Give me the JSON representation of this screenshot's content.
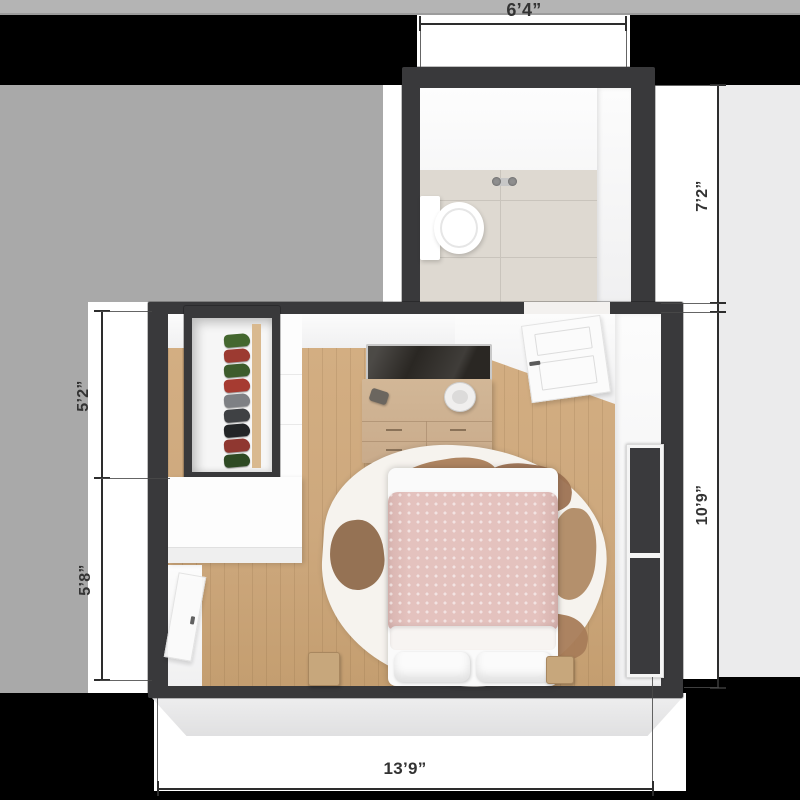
{
  "figure": "3d-floor-plan-top-view",
  "dimensions": {
    "top": "6’4”",
    "right_upper": "7’2”",
    "right_lower": "10’9”",
    "left_upper": "5’2”",
    "left_lower": "5’8”",
    "bottom": "13’9”"
  },
  "palette": {
    "background": "#000000",
    "backdrop_gray": "#a9a9a9",
    "backdrop_light": "#ebebec",
    "top_strip": "#b4b4b4",
    "strip_line": "#9c9c9c",
    "wall": "#39393b",
    "wood_floor": "#cda87d",
    "tile_floor": "#ded9d1",
    "duvet_pink": "#e4c2be",
    "furniture_wood": "#c9ab8b",
    "dim_color": "#2d2d2d"
  },
  "closet": {
    "shoe_colors": [
      "#44672f",
      "#9c3a31",
      "#3d5c2c",
      "#a63b31",
      "#7e8084",
      "#3f4144",
      "#232527",
      "#8f3730",
      "#2e4a24"
    ]
  },
  "rooms": [
    "bathroom",
    "bedroom"
  ]
}
